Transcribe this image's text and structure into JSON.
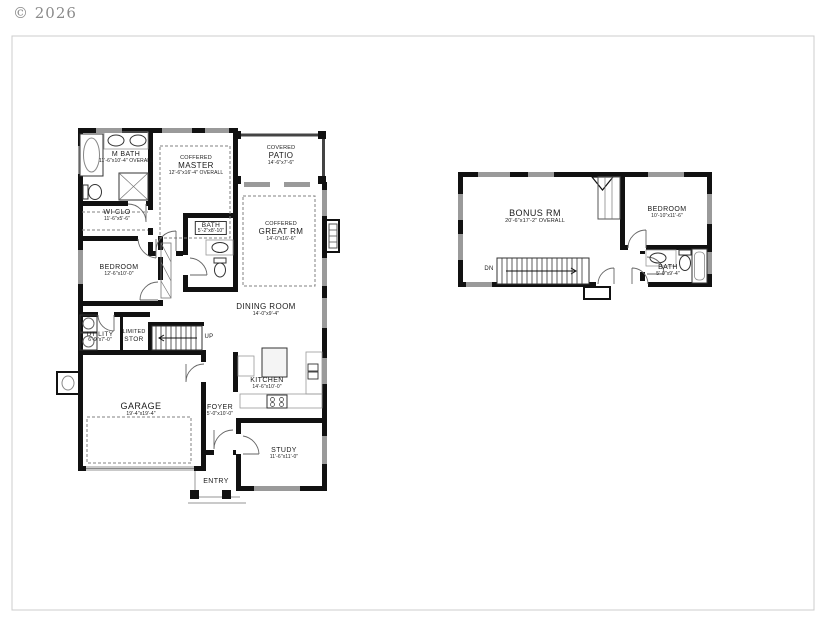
{
  "meta": {
    "copyright": "© 2026"
  },
  "floor1": {
    "rooms": {
      "mbath": {
        "name": "M BATH",
        "dims": "11'-6\"x10'-4\" OVERALL"
      },
      "master": {
        "prefix": "COFFERED",
        "name": "MASTER",
        "dims": "12'-6\"x16'-4\" OVERALL"
      },
      "patio": {
        "prefix": "COVERED",
        "name": "PATIO",
        "dims": "14'-6\"x7'-6\""
      },
      "greatrm": {
        "prefix": "COFFERED",
        "name": "GREAT RM",
        "dims": "14'-0\"x16'-6\""
      },
      "wiclo": {
        "name": "WI CLO",
        "dims": "11'-6\"x5'-6\""
      },
      "bath": {
        "name": "BATH",
        "dims": "5'-2\"x8'-10\""
      },
      "bedroom": {
        "name": "BEDROOM",
        "dims": "12'-6\"x10'-0\""
      },
      "dining": {
        "name": "DINING ROOM",
        "dims": "14'-0\"x9'-4\""
      },
      "utility": {
        "name": "UTILITY",
        "dims": "6'-9\"x7'-0\""
      },
      "stor": {
        "prefix": "LIMITED",
        "name": "STOR"
      },
      "kitchen": {
        "name": "KITCHEN",
        "dims": "14'-6\"x10'-0\""
      },
      "garage": {
        "name": "GARAGE",
        "dims": "19'-4\"x19'-4\""
      },
      "foyer": {
        "name": "FOYER",
        "dims": "5'-0\"x10'-0\""
      },
      "study": {
        "name": "STUDY",
        "dims": "11'-6\"x11'-0\""
      },
      "entry": {
        "name": "ENTRY"
      }
    },
    "stairs_label": "UP"
  },
  "floor2": {
    "rooms": {
      "bonus": {
        "name": "BONUS RM",
        "dims": "20'-6\"x17'-2\" OVERALL"
      },
      "bedroom2": {
        "name": "BEDROOM",
        "dims": "10'-10\"x11'-6\""
      },
      "bath2": {
        "name": "BATH",
        "dims": "5'-0\"x9'-4\""
      }
    },
    "stairs_label": "DN"
  },
  "colors": {
    "wall": "#111111",
    "window": "#9a9a9a",
    "dashed_line": "#808080",
    "label_text": "#1b1b1b",
    "copyright_text": "#8a8a8a",
    "sheet_frame": "#cccccc"
  }
}
